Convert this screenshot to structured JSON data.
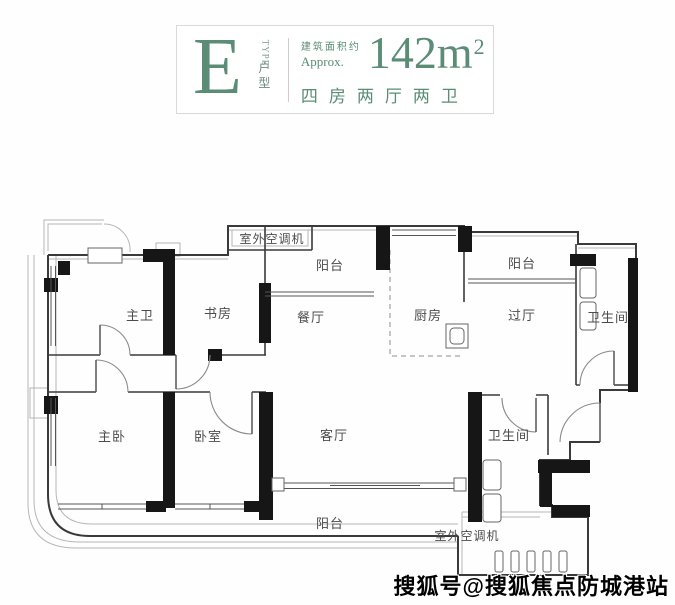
{
  "header": {
    "type_letter": "E",
    "type_en": "TYPE",
    "type_cn": "户型",
    "area_label_cn": "建筑面积约",
    "area_label_en": "Approx.",
    "area_value": "142m",
    "area_exponent": "2",
    "layout_desc": "四房两厅两卫"
  },
  "plan": {
    "rooms": [
      {
        "text": "室外空调机",
        "x": 272,
        "y": 243,
        "size": 12
      },
      {
        "text": "阳台",
        "x": 330,
        "y": 270,
        "size": 13
      },
      {
        "text": "餐厅",
        "x": 311,
        "y": 322,
        "size": 13
      },
      {
        "text": "厨房",
        "x": 428,
        "y": 320,
        "size": 13
      },
      {
        "text": "阳台",
        "x": 522,
        "y": 268,
        "size": 13
      },
      {
        "text": "过厅",
        "x": 522,
        "y": 320,
        "size": 13
      },
      {
        "text": "卫生间",
        "x": 608,
        "y": 322,
        "size": 13
      },
      {
        "text": "主卫",
        "x": 140,
        "y": 320,
        "size": 13
      },
      {
        "text": "书房",
        "x": 218,
        "y": 318,
        "size": 13
      },
      {
        "text": "主卧",
        "x": 112,
        "y": 441,
        "size": 13
      },
      {
        "text": "卧室",
        "x": 208,
        "y": 441,
        "size": 13
      },
      {
        "text": "客厅",
        "x": 334,
        "y": 440,
        "size": 13
      },
      {
        "text": "卫生间",
        "x": 509,
        "y": 440,
        "size": 13
      },
      {
        "text": "阳台",
        "x": 330,
        "y": 528,
        "size": 13
      },
      {
        "text": "室外空调机",
        "x": 467,
        "y": 540,
        "size": 12
      }
    ]
  },
  "watermark": {
    "text": "搜狐号@搜狐焦点防城港站"
  },
  "colors": {
    "accent": "#5a8c76",
    "wall": "#3a3a3a",
    "structural_wall": "#161616"
  }
}
